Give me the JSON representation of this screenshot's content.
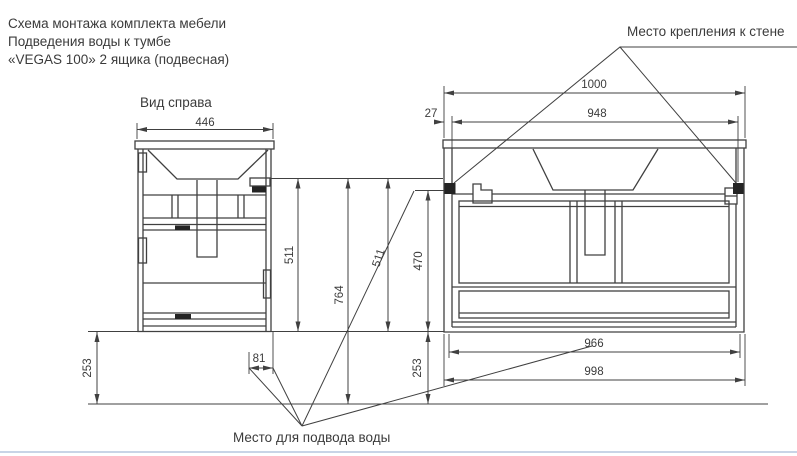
{
  "title": {
    "line1": "Схема монтажа комплекта мебели",
    "line2": "Подведения воды к тумбе",
    "line3": "«VEGAS 100» 2 ящика (подвесная)"
  },
  "labels": {
    "side_view": "Вид справа",
    "wall_mount": "Место крепления к стене",
    "water_supply": "Место для подвода воды"
  },
  "side_view_dims": {
    "width": "446",
    "height_with_top": "511",
    "height_to_floor": "764",
    "floor_gap": "253",
    "water_offset": "81"
  },
  "front_view_dims": {
    "total_width": "1000",
    "mount_offset": "27",
    "mount_span": "948",
    "height_with_top": "511",
    "body_height": "470",
    "floor_gap": "253",
    "bottom_inner_width": "966",
    "bottom_width": "998"
  },
  "colors": {
    "line": "#404040",
    "accent_line": "#b6c6de"
  }
}
